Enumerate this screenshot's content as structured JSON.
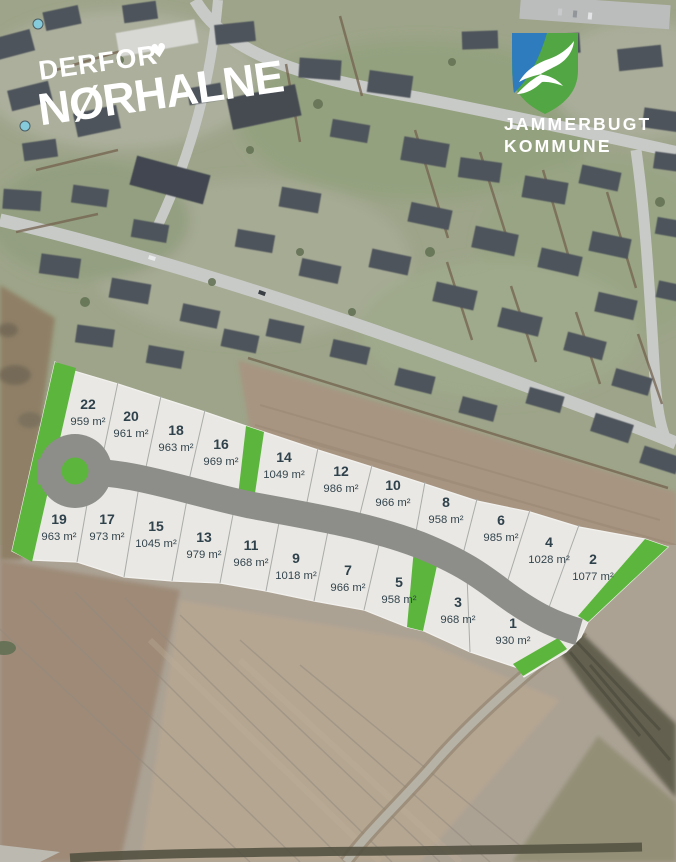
{
  "branding": {
    "prefix": "DERFOR",
    "heart": "♥",
    "city": "NØRHALNE"
  },
  "municipality": {
    "name_line1": "JAMMERBUGT",
    "name_line2": "KOMMUNE"
  },
  "colors": {
    "plot_fill": "#eae8e4",
    "plot_green": "#5cb53c",
    "road_gray": "#8d8e8a",
    "label_text": "#33454e",
    "logo_blue": "#2e7cbd",
    "logo_green": "#52a643"
  },
  "plots": [
    {
      "number": "22",
      "area": "959 m²"
    },
    {
      "number": "20",
      "area": "961 m²"
    },
    {
      "number": "18",
      "area": "963 m²"
    },
    {
      "number": "16",
      "area": "969 m²"
    },
    {
      "number": "14",
      "area": "1049 m²"
    },
    {
      "number": "12",
      "area": "986 m²"
    },
    {
      "number": "10",
      "area": "966 m²"
    },
    {
      "number": "8",
      "area": "958 m²"
    },
    {
      "number": "6",
      "area": "985 m²"
    },
    {
      "number": "4",
      "area": "1028 m²"
    },
    {
      "number": "2",
      "area": "1077 m²"
    },
    {
      "number": "19",
      "area": "963 m²"
    },
    {
      "number": "17",
      "area": "973 m²"
    },
    {
      "number": "15",
      "area": "1045 m²"
    },
    {
      "number": "13",
      "area": "979 m²"
    },
    {
      "number": "11",
      "area": "968 m²"
    },
    {
      "number": "9",
      "area": "1018 m²"
    },
    {
      "number": "7",
      "area": "966 m²"
    },
    {
      "number": "5",
      "area": "958 m²"
    },
    {
      "number": "3",
      "area": "968 m²"
    },
    {
      "number": "1",
      "area": "930 m²"
    }
  ]
}
